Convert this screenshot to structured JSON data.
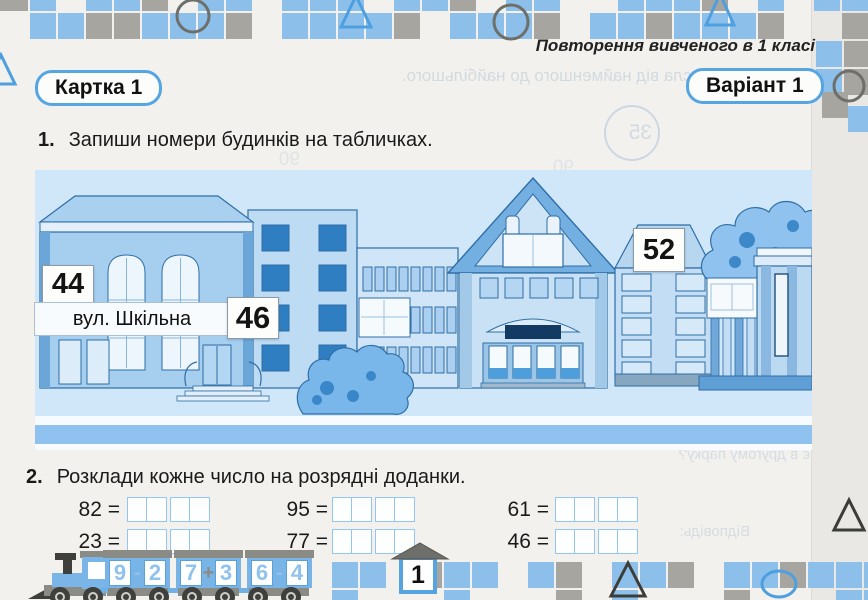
{
  "header": {
    "topic": "Повторення вивченого в 1 класі",
    "card_label": "Картка 1",
    "variant_label": "Варіант 1"
  },
  "task1": {
    "number": "1.",
    "text": "Запиши номери будинків на табличках."
  },
  "scene": {
    "street_sign": "вул. Шкільна",
    "houses": [
      {
        "number": "44"
      },
      {
        "number": "46"
      },
      {
        "number": "52"
      }
    ]
  },
  "task2": {
    "number": "2.",
    "text": "Розклади кожне число на розрядні доданки.",
    "rows": [
      [
        "82 =",
        "95 =",
        "61 ="
      ],
      [
        "23 =",
        "77 =",
        "46 ="
      ]
    ]
  },
  "train": {
    "cars": [
      {
        "a": "9",
        "op": "-",
        "b": "2"
      },
      {
        "a": "7",
        "op": "+",
        "b": "3"
      },
      {
        "a": "6",
        "op": "-",
        "b": "4"
      }
    ]
  },
  "footer": {
    "page_number": "1"
  },
  "show_through": {
    "line1": "числа від найменшого до найбільшого.",
    "line2": "є в другому парку?",
    "answer": "Відповідь:",
    "circled": "35",
    "ghost1": "90",
    "ghost2": "90"
  },
  "colors": {
    "accent_blue": "#55a5e3",
    "mosaic_blue": "#8cc0ea",
    "mosaic_gray": "#a7a5a0",
    "scene_sky": "#cfe7f8",
    "road_blue": "#8fc2ee",
    "window_dark_blue": "#2f7ec2",
    "outline_blue": "#2f6ea5",
    "train_gray": "#8b8b86",
    "digit_blue": "#8fc2ec"
  },
  "decor": {
    "mosaic": {
      "cell": 26,
      "pitch": 28,
      "colors": {
        "b": "#8cc0ea",
        "g": "#a7a5a0"
      },
      "top_rows": [
        {
          "x0": 2,
          "y": -15,
          "pattern": "gb.bbg.bb.bbb.bbg.bb..bbbg.b.bb"
        },
        {
          "x0": 2,
          "y": 13,
          "pattern": ".bbggbbbg.bbbbg.bbbg.bbgbbbg..g"
        }
      ],
      "cluster": [
        {
          "x": -14,
          "y": -15,
          "c": "g"
        },
        {
          "x": 816,
          "y": 41,
          "c": "b"
        },
        {
          "x": 844,
          "y": 41,
          "c": "g"
        },
        {
          "x": 844,
          "y": 69,
          "c": "g"
        },
        {
          "x": 816,
          "y": 69,
          "c": "b"
        },
        {
          "x": 822,
          "y": 92,
          "c": "g"
        },
        {
          "x": 848,
          "y": 106,
          "c": "b"
        }
      ],
      "bottom_rows": [
        {
          "x0": 332,
          "y": 562,
          "pattern": "bb.gbb.bg.bbg.bbgbbb"
        },
        {
          "x0": 332,
          "y": 590,
          "pattern": "b...b...g.b...g...bb"
        }
      ]
    },
    "shapes": [
      {
        "t": "circle",
        "cx": 193,
        "cy": 16,
        "r": 16,
        "s": "#6e6e6a",
        "w": 3
      },
      {
        "t": "tri",
        "p": "356,-4 371,27 341,27",
        "s": "#4d9fe0",
        "w": 3
      },
      {
        "t": "circle",
        "cx": 511,
        "cy": 22,
        "r": 17,
        "s": "#6e6e6a",
        "w": 3
      },
      {
        "t": "tri",
        "p": "720,-6 734,25 706,25",
        "s": "#4d9fe0",
        "w": 3
      },
      {
        "t": "circle",
        "cx": 849,
        "cy": 86,
        "r": 15,
        "s": "#6e6e6a",
        "w": 3
      },
      {
        "t": "tri",
        "p": "1,55 15,84 -13,84",
        "s": "#4d9fe0",
        "w": 3
      },
      {
        "t": "tri",
        "p": "628,563 645,596 611,596",
        "s": "#3c3c39",
        "w": 3
      },
      {
        "t": "ellipse",
        "cx": 779,
        "cy": 584,
        "rx": 17,
        "ry": 13,
        "s": "#4d9fe0",
        "w": 3
      },
      {
        "t": "tri",
        "p": "849,500 864,530 834,530",
        "s": "#3c3c39",
        "w": 3
      },
      {
        "t": "circle",
        "cx": 632,
        "cy": 133,
        "r": 27,
        "s": "#ccd7e4",
        "w": 2
      },
      {
        "t": "tri",
        "p": "420,543 448,559 392,559",
        "f": "#6e6e6a",
        "s": "#55554f",
        "w": 1
      }
    ]
  }
}
